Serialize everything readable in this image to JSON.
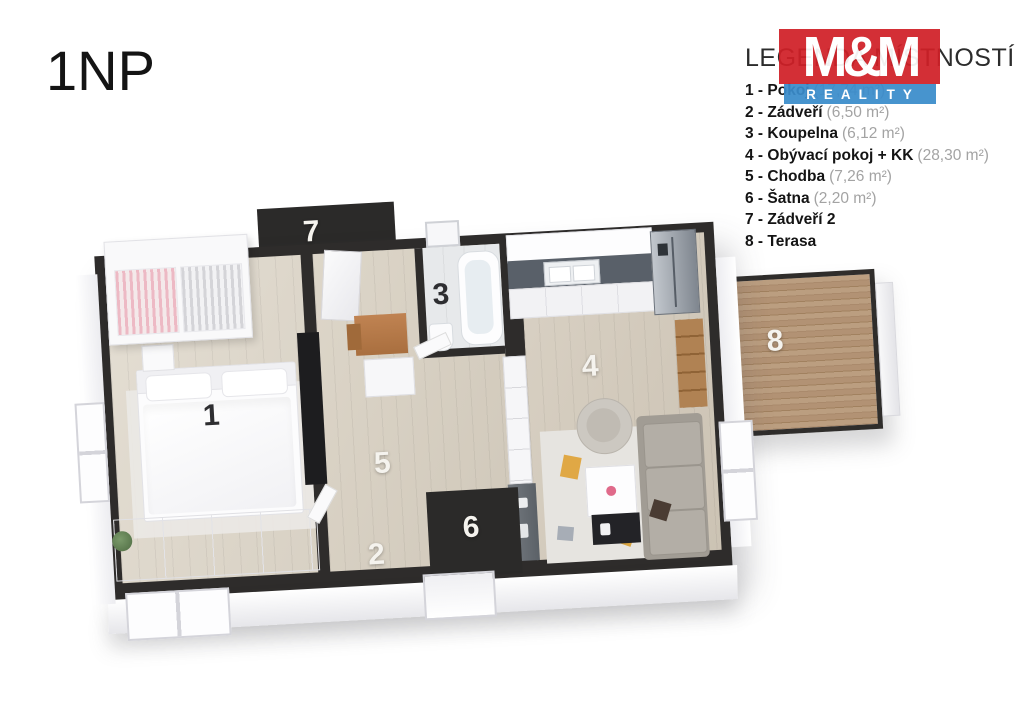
{
  "page": {
    "title": "1NP",
    "background": "#ffffff"
  },
  "logo": {
    "mm": "M&M",
    "reality": "REALITY",
    "red": "#d02027",
    "blue": "#3a8ccb"
  },
  "legend": {
    "title": "LEGENDA MÍSTNOSTÍ",
    "items": [
      {
        "label": "1 - Pokoj",
        "area": "(17,74 m²)"
      },
      {
        "label": "2 - Zádveří",
        "area": "(6,50 m²)"
      },
      {
        "label": "3 - Koupelna",
        "area": "(6,12 m²)"
      },
      {
        "label": "4 - Obývací pokoj + KK",
        "area": "(28,30 m²)"
      },
      {
        "label": "5 - Chodba",
        "area": "(7,26 m²)"
      },
      {
        "label": "6 - Šatna",
        "area": "(2,20 m²)"
      },
      {
        "label": "7 - Zádveří 2",
        "area": ""
      },
      {
        "label": "8 - Terasa",
        "area": ""
      }
    ]
  },
  "plan": {
    "wall_color": "#2e2c2b",
    "wood_floor_color": "#d8d1c4",
    "terrace_deck_color": "#ad8d6e",
    "rooms": [
      {
        "number": "1",
        "name": "Pokoj"
      },
      {
        "number": "2",
        "name": "Zádveří"
      },
      {
        "number": "3",
        "name": "Koupelna"
      },
      {
        "number": "4",
        "name": "Obývací pokoj + KK"
      },
      {
        "number": "5",
        "name": "Chodba"
      },
      {
        "number": "6",
        "name": "Šatna"
      },
      {
        "number": "7",
        "name": "Zádveří 2"
      },
      {
        "number": "8",
        "name": "Terasa"
      }
    ]
  }
}
